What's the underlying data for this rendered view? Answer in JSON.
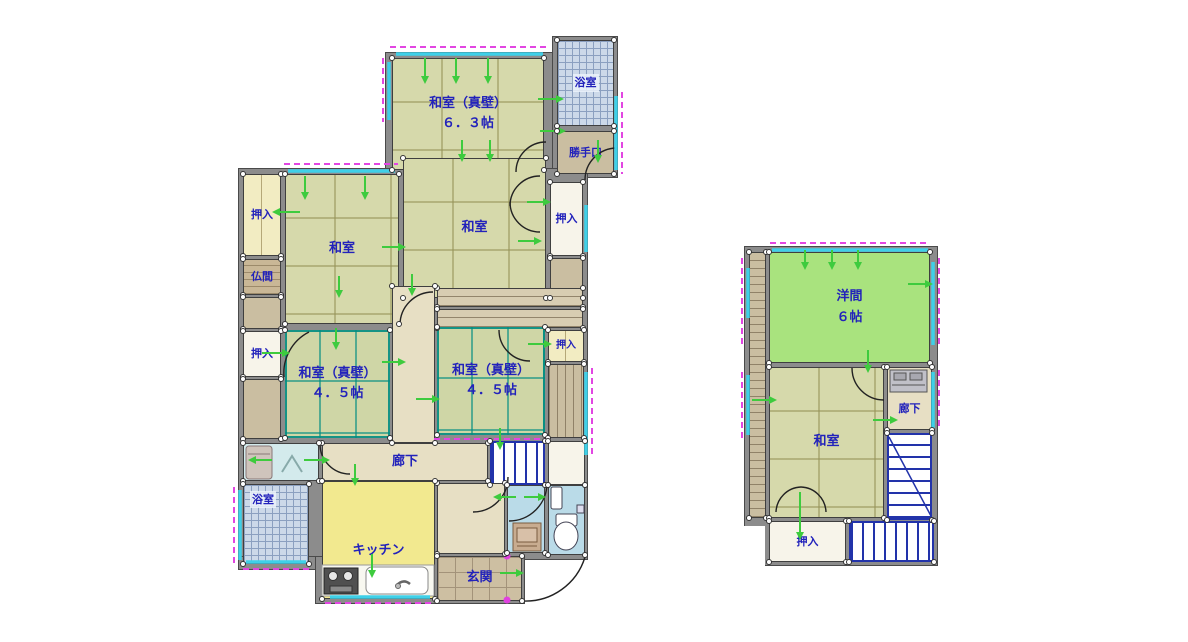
{
  "floorplan": {
    "floor1": {
      "labels": {
        "washitsu_shinkabe": "和室（真壁）",
        "size_6_3": "６．３帖",
        "size_4_5": "４．５帖",
        "washitsu": "和室",
        "bath": "浴室",
        "katteguchi": "勝手口",
        "oshiire": "押入",
        "butsuma": "仏間",
        "rouka": "廊下",
        "kitchen": "キッチン",
        "genkan": "玄関"
      }
    },
    "floor2": {
      "labels": {
        "youma": "洋間",
        "size_6": "６帖",
        "washitsu": "和室",
        "rouka": "廊下",
        "oshiire": "押入"
      }
    },
    "colors": {
      "label_text": "#2222bb",
      "wall": "#8c8c8c",
      "tatami": "#d6d9ab",
      "green_room": "#a9e37e",
      "kitchen": "#f2e98f",
      "corridor": "#e7dfc4",
      "closet_yellow": "#f2ecc2",
      "closet_white": "#f7f4ea",
      "tan": "#cabea1",
      "tile_tan": "#cdbfa2",
      "bath_fill": "#ccd9e9",
      "bath_line": "#8ba0c0",
      "toilet_fill": "#badbe8",
      "laundry_fill": "#d3eaec",
      "stairs_line": "#2233aa",
      "window_glass": "#3fd0e8",
      "shutter_dash": "#e246e2",
      "arrow_green": "#3ecb3e"
    }
  }
}
